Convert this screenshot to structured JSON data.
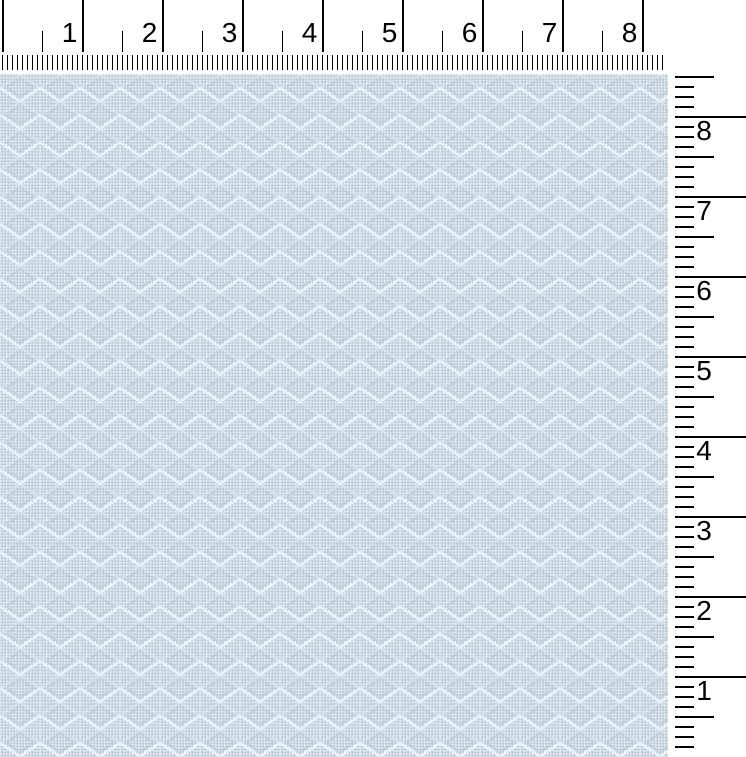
{
  "rulers": {
    "unit_system": "inches",
    "tick_color": "#000000",
    "top": {
      "labels": [
        "1",
        "2",
        "3",
        "4",
        "5",
        "6",
        "7",
        "8"
      ]
    },
    "right": {
      "labels": [
        "8",
        "7",
        "6",
        "5",
        "4",
        "3",
        "2",
        "1"
      ]
    }
  },
  "fabric": {
    "pattern_name": "diamond-lattice-weave",
    "colors": {
      "base": "#cbd7e1",
      "dot_light": "#eef3f7",
      "dot_dark": "#afc3d2",
      "lattice": "#f8fbfd",
      "lattice_soft": "#dde7ee",
      "inner_band": "#b9cbd9"
    }
  }
}
